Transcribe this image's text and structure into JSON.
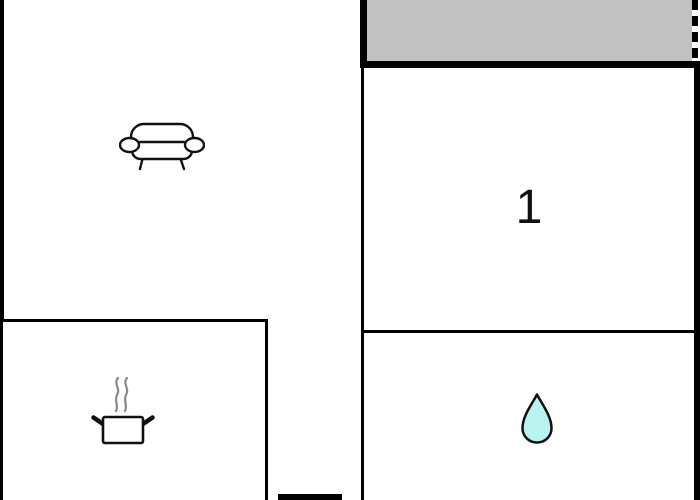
{
  "floorplan": {
    "rooms": [
      {
        "name": "balcony",
        "label": "",
        "icon": ""
      },
      {
        "name": "living-room",
        "label": "",
        "icon": "sofa-icon"
      },
      {
        "name": "kitchen",
        "label": "",
        "icon": "cooking-pot-icon"
      },
      {
        "name": "bedroom-1",
        "label": "1",
        "icon": ""
      },
      {
        "name": "bathroom",
        "label": "",
        "icon": "water-drop-icon"
      }
    ],
    "colors": {
      "wall": "#000000",
      "balcony_fill": "#c2c2c2",
      "water_drop_fill": "#b9f2ee",
      "steam_gray": "#8a8a8a",
      "background": "#ffffff",
      "icon_outline": "#111111"
    }
  }
}
